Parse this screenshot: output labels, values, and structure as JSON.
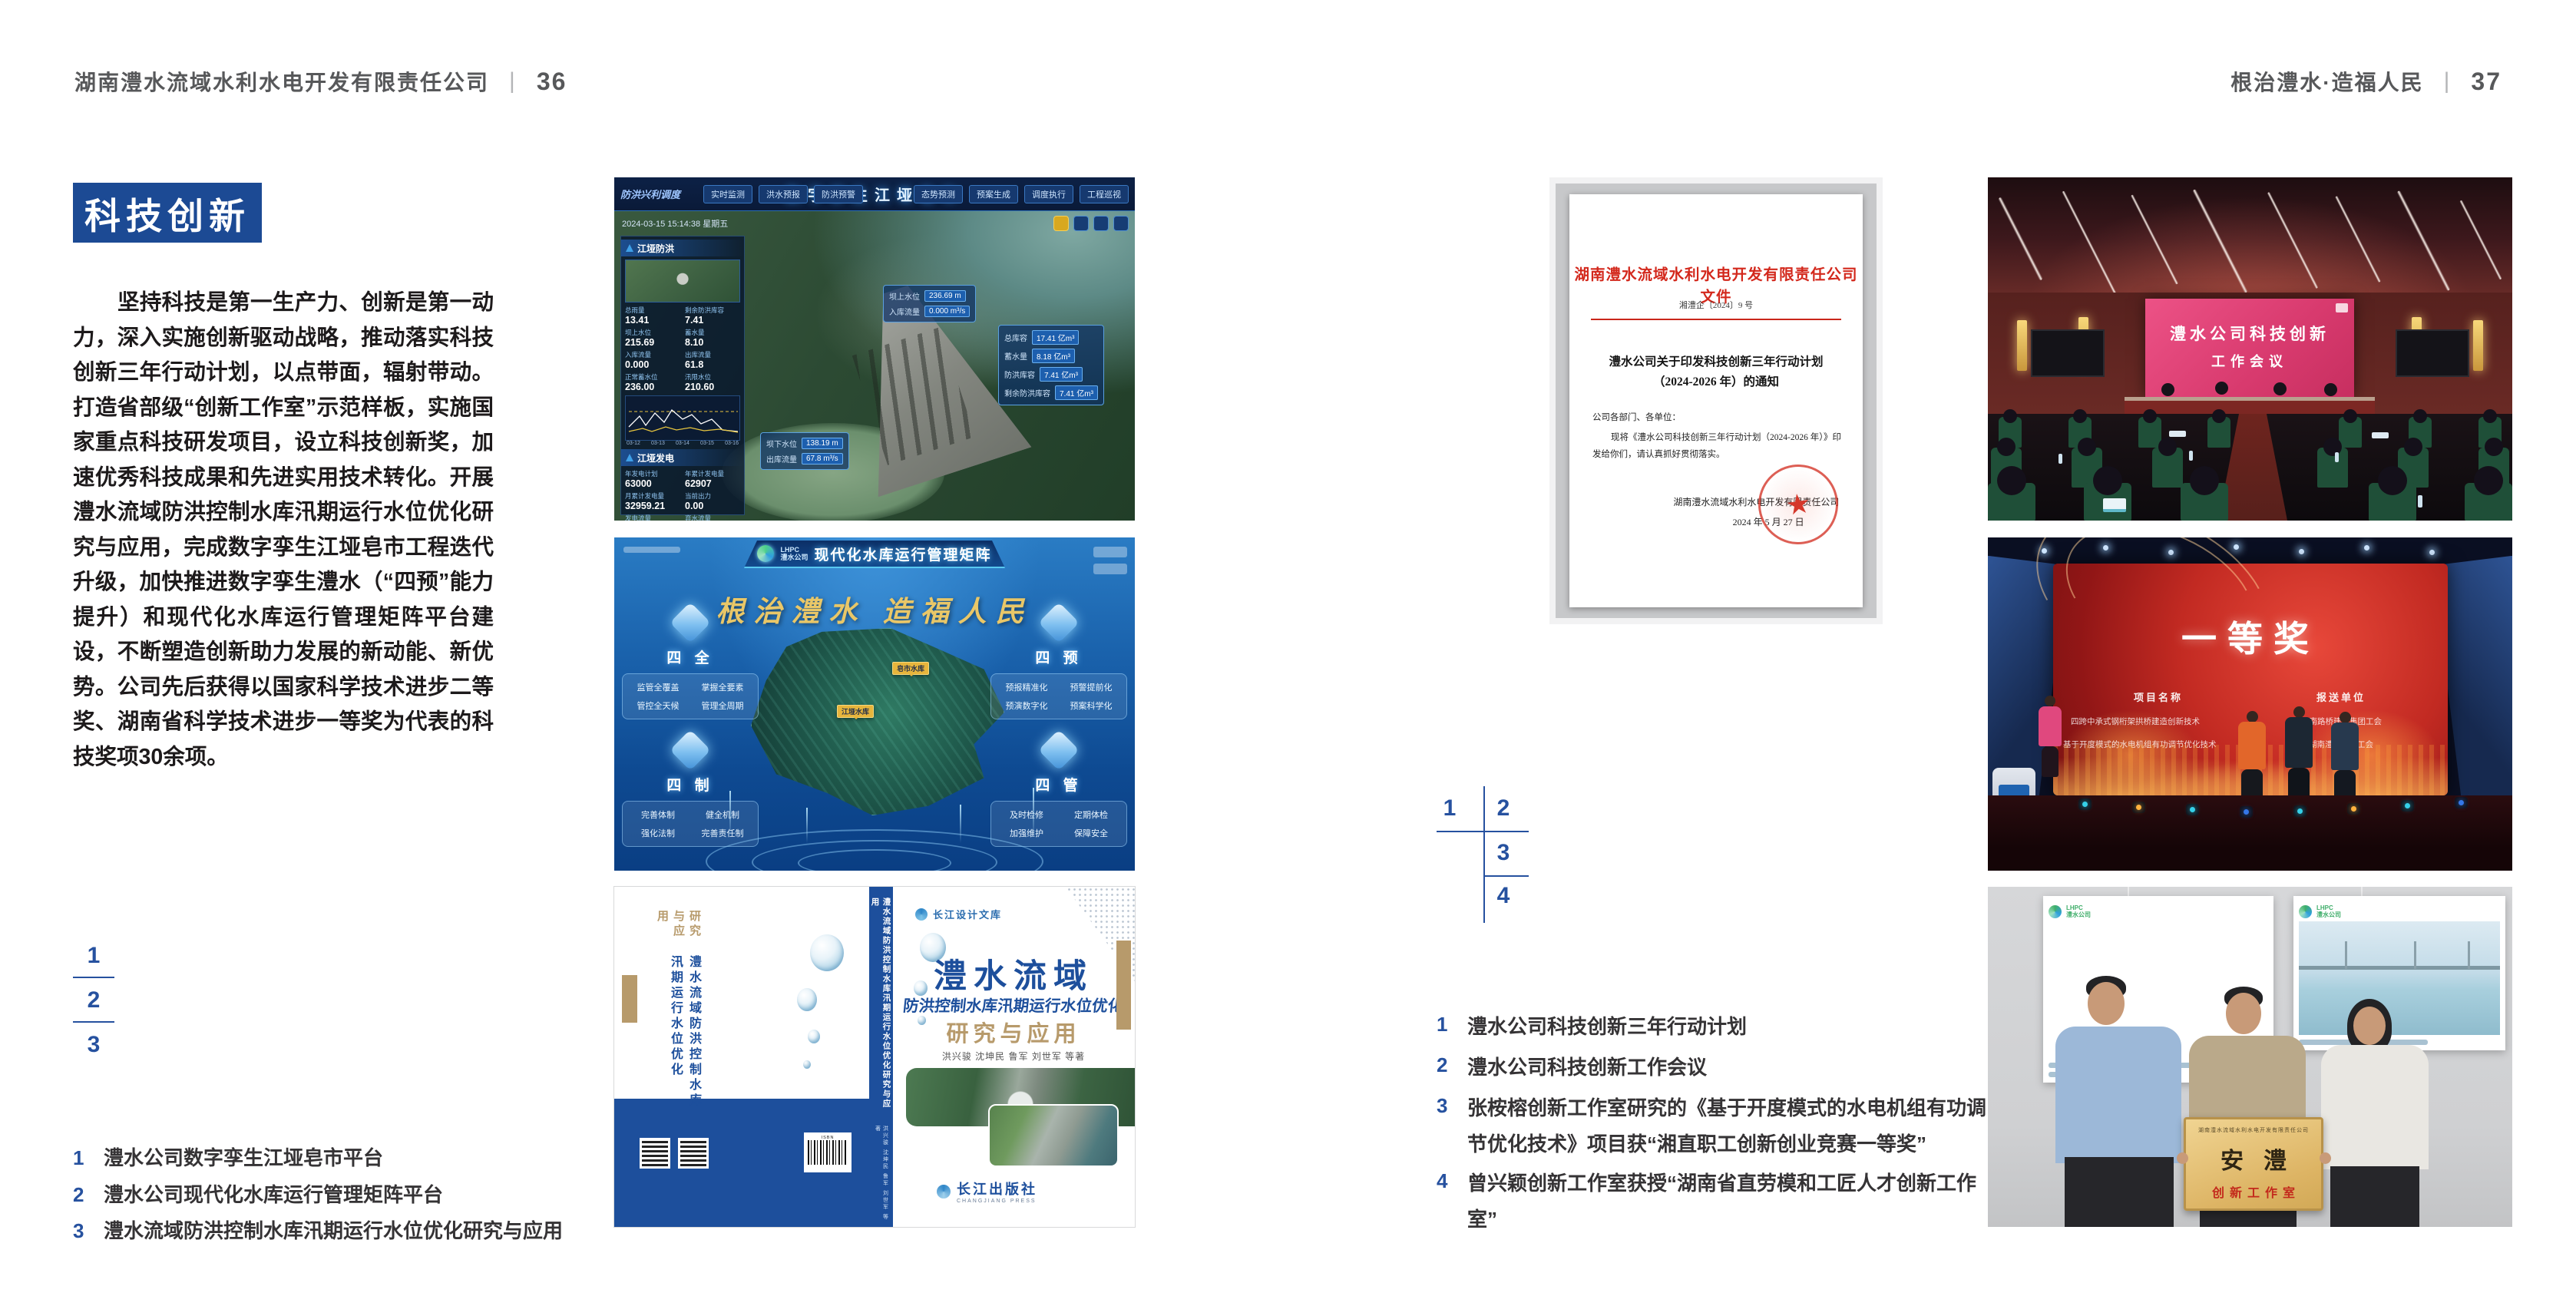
{
  "colors": {
    "accent_blue": "#1c4a94",
    "caption_blue": "#26519f",
    "doc_red": "#d3281c",
    "gold": "#b79a6b"
  },
  "left": {
    "header": {
      "company": "湖南澧水流域水利水电开发有限责任公司",
      "divider": "|",
      "page": "36"
    },
    "section_title": "科技创新",
    "paragraph": "坚持科技是第一生产力、创新是第一动力，深入实施创新驱动战略，推动落实科技创新三年行动计划，以点带面，辐射带动。打造省部级“创新工作室”示范样板，实施国家重点科技研发项目，设立科技创新奖，加速优秀科技成果和先进实用技术转化。开展澧水流域防洪控制水库汛期运行水位优化研究与应用，完成数字孪生江垭皂市工程迭代升级，加快推进数字孪生澧水（“四预”能力提升）和现代化水库运行管理矩阵平台建设，不断塑造创新助力发展的新动能、新优势。公司先后获得以国家科学技术进步二等奖、湖南省科学技术进步一等奖为代表的科技奖项30余项。",
    "figure_index": {
      "n1": "1",
      "n2": "2",
      "n3": "3"
    },
    "captions": [
      {
        "num": "1",
        "text": "澧水公司数字孪生江垭皂市平台"
      },
      {
        "num": "2",
        "text": "澧水公司现代化水库运行管理矩阵平台"
      },
      {
        "num": "3",
        "text": "澧水流域防洪控制水库汛期运行水位优化研究与应用"
      }
    ],
    "fig1": {
      "title": "数字孪生江垭皂市",
      "corner_label": "防洪兴利调度",
      "timestamp": "2024-03-15 15:14:38 星期五",
      "tabs_left": [
        "实时监测",
        "洪水预报",
        "防洪预警"
      ],
      "tabs_right": [
        "态势预测",
        "预案生成",
        "调度执行",
        "工程巡视"
      ],
      "panel1_title": "江垭防洪",
      "panel1_stats": [
        {
          "k": "总雨量",
          "v": "13.41"
        },
        {
          "k": "剩余防洪库容",
          "v": "7.41"
        },
        {
          "k": "坝上水位",
          "v": "215.69"
        },
        {
          "k": "蓄水量",
          "v": "8.10"
        },
        {
          "k": "入库流量",
          "v": "0.000"
        },
        {
          "k": "出库流量",
          "v": "61.8"
        },
        {
          "k": "正常蓄水位",
          "v": "236.00"
        },
        {
          "k": "汛限水位",
          "v": "210.60"
        }
      ],
      "chart_x": [
        "03-12",
        "03-13",
        "03-14",
        "03-15",
        "03-16"
      ],
      "panel2_title": "江垭发电",
      "panel2_stats": [
        {
          "k": "年发电计划",
          "v": "63000"
        },
        {
          "k": "年累计发电量",
          "v": "62907"
        },
        {
          "k": "月累计发电量",
          "v": "32959.21"
        },
        {
          "k": "当前出力",
          "v": "0.00"
        },
        {
          "k": "发电流量",
          "v": "0.00"
        },
        {
          "k": "弃水流量",
          "v": "0.00"
        }
      ],
      "gauges": [
        "1#机组",
        "2#机组",
        "3#机组"
      ],
      "callout1": [
        {
          "k": "坝上水位",
          "v": "236.69 m"
        },
        {
          "k": "入库流量",
          "v": "0.000 m³/s"
        }
      ],
      "callout2": [
        {
          "k": "总库容",
          "v": "17.41 亿m³"
        },
        {
          "k": "蓄水量",
          "v": "8.18 亿m³"
        },
        {
          "k": "防洪库容",
          "v": "7.41 亿m³"
        },
        {
          "k": "剩余防洪库容",
          "v": "7.41 亿m³"
        }
      ],
      "callout3": [
        {
          "k": "坝下水位",
          "v": "138.19 m"
        },
        {
          "k": "出库流量",
          "v": "67.8 m³/s"
        }
      ]
    },
    "fig2": {
      "logo_top": "LHPC",
      "logo_bottom": "澧水公司",
      "title": "现代化水库运行管理矩阵",
      "slogan": "根治澧水  造福人民",
      "map_labels": [
        "江垭水库",
        "皂市水库"
      ],
      "modules": [
        {
          "name": "四 全",
          "items": [
            "监管全覆盖",
            "掌握全要素",
            "管控全天候",
            "管理全周期"
          ]
        },
        {
          "name": "四 预",
          "items": [
            "预报精准化",
            "预警提前化",
            "预演数字化",
            "预案科学化"
          ]
        },
        {
          "name": "四 制",
          "items": [
            "完善体制",
            "健全机制",
            "强化法制",
            "完善责任制"
          ]
        },
        {
          "name": "四 管",
          "items": [
            "及时检修",
            "定期体检",
            "加强维护",
            "保障安全"
          ]
        }
      ]
    },
    "fig3": {
      "badge": "长江设计文库",
      "title": "澧水流域",
      "subtitle": "防洪控制水库汛期运行水位优化",
      "series": "研究与应用",
      "authors": "洪兴骏  沈坤民  鲁军  刘世军  等著",
      "back_title_blue": "澧水流域防洪控制水库汛期运行水位优化",
      "back_title_gold": "研究与应用",
      "spine": "澧水流域防洪控制水库汛期运行水位优化研究与应用",
      "spine_authors": "洪兴骏 沈坤民 鲁军 刘世军 等著",
      "isbn_label": "ISBN",
      "publisher": "长江出版社",
      "publisher_en": "CHANGJIANG PRESS"
    }
  },
  "right": {
    "header": {
      "motto": "根治澧水·造福人民",
      "divider": "|",
      "page": "37"
    },
    "figure_index": {
      "n1": "1",
      "n2": "2",
      "n3": "3",
      "n4": "4"
    },
    "captions": [
      {
        "num": "1",
        "text": "澧水公司科技创新三年行动计划"
      },
      {
        "num": "2",
        "text": "澧水公司科技创新工作会议"
      },
      {
        "num": "3",
        "text": "张桉榕创新工作室研究的《基于开度模式的水电机组有功调节优化技术》项目获“湘直职工创新创业竞赛一等奖”"
      },
      {
        "num": "4",
        "text": "曾兴颖创新工作室获授“湖南省直劳模和工匠人才创新工作室”"
      }
    ],
    "doc": {
      "header": "湖南澧水流域水利水电开发有限责任公司文件",
      "number": "湘澧企〔2024〕9 号",
      "title_line1": "澧水公司关于印发科技创新三年行动计划",
      "title_line2": "（2024-2026 年）的通知",
      "salutation": "公司各部门、各单位：",
      "body_line1": "现将《澧水公司科技创新三年行动计划（2024-2026 年）》印",
      "body_line2": "发给你们，请认真抓好贯彻落实。",
      "signer": "湖南澧水流域水利水电开发有限责任公司",
      "date": "2024 年 5 月 27 日",
      "seal_star": "★"
    },
    "meeting": {
      "screen_line1": "澧水公司科技创新",
      "screen_line2": "工作会议"
    },
    "award": {
      "title": "一等奖",
      "col1": "项目名称",
      "col2": "报送单位",
      "projects": [
        "四跨中承式钢桁架拱桥建造创新技术",
        "基于开度模式的水电机组有功调节优化技术"
      ],
      "units": [
        "湖南路桥建设集团工会",
        "湖南澧水公司工会"
      ]
    },
    "group": {
      "logo_top": "LHPC",
      "logo_bottom": "澧水公司",
      "plaque_org": "湖南澧水流域水利水电开发有限责任公司",
      "plaque_main": "安澧",
      "plaque_sub": "创新工作室"
    }
  }
}
